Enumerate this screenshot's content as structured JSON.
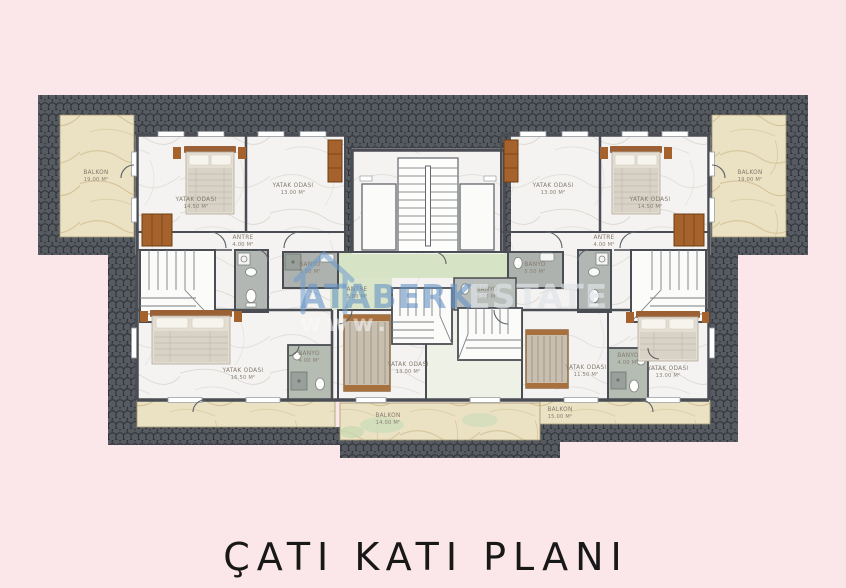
{
  "plan": {
    "title": "ÇATI KATI PLANI",
    "rooms": [
      {
        "name": "BALKON",
        "area": "19.00 M²"
      },
      {
        "name": "YATAK ODASI",
        "area": "14.50 M²"
      },
      {
        "name": "YATAK ODASI",
        "area": "13.00 M²"
      },
      {
        "name": "ANTRE",
        "area": "4.00 M²"
      },
      {
        "name": "BANYO",
        "area": "5.50 M²"
      },
      {
        "name": "ANTRE",
        "area": "5.00 M²"
      },
      {
        "name": "YATAK ODASI",
        "area": "16.50 M²"
      },
      {
        "name": "BANYO",
        "area": "4.00 M²"
      },
      {
        "name": "YATAK ODASI",
        "area": "13.00 M²"
      },
      {
        "name": "BALKON",
        "area": "14.00 M²"
      },
      {
        "name": "BALKON",
        "area": "19.00 M²"
      },
      {
        "name": "YATAK ODASI",
        "area": "13.00 M²"
      },
      {
        "name": "YATAK ODASI",
        "area": "14.50 M²"
      },
      {
        "name": "ANTRE",
        "area": "4.00 M²"
      },
      {
        "name": "BANYO",
        "area": "5.50 M²"
      },
      {
        "name": "BANYO",
        "area": "4.00 M²"
      },
      {
        "name": "YATAK ODASI",
        "area": "11.50 M²"
      },
      {
        "name": "YATAK ODASI",
        "area": "13.00 M²"
      },
      {
        "name": "BALKON",
        "area": "15.00 M²"
      },
      {
        "name": "BANYO",
        "area": "4.00 M²"
      }
    ]
  },
  "watermark": {
    "brand": "ATABERK",
    "brand_suffix": "ESTATE",
    "url": "www.",
    "accent_color": "#6794c8"
  },
  "colors": {
    "background": "#fbe7e9",
    "roof": "#45484e",
    "wall": "#4a4d53",
    "balcony_marble": "#ebe1c3",
    "terrace_green": "#d7e3c5",
    "label_text": "#847b6f"
  }
}
